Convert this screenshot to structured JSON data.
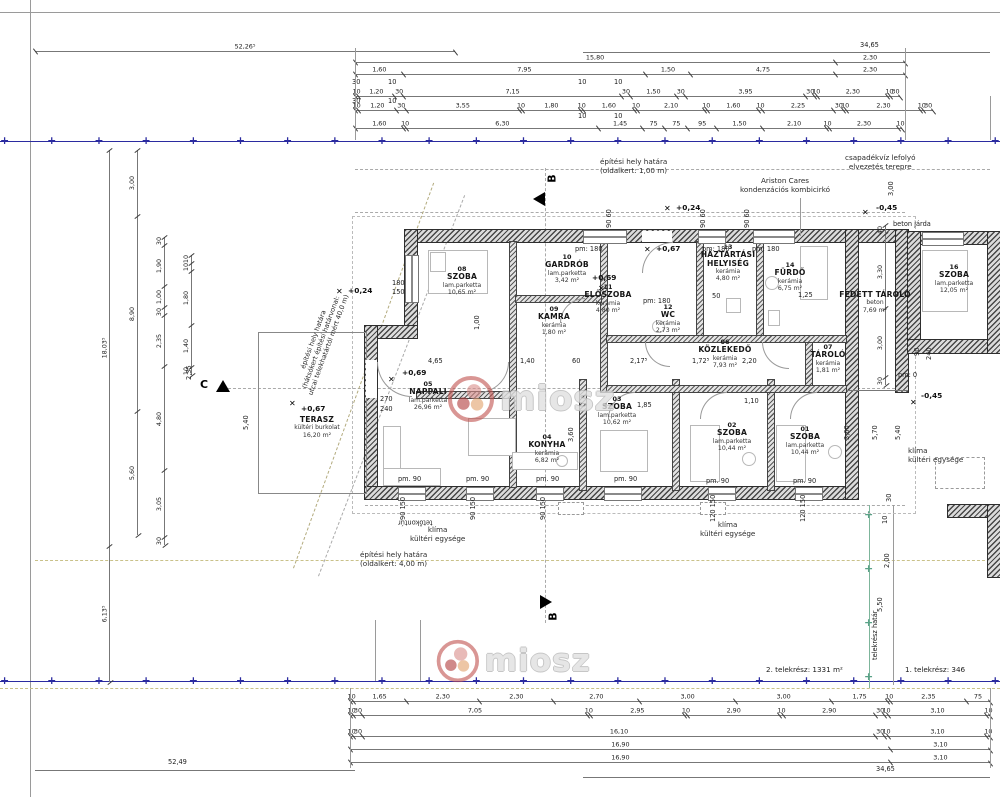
{
  "watermark": {
    "text": "miosz"
  },
  "rooms": {
    "r01": {
      "num": "01",
      "name": "SZOBA",
      "finish": "lam.parketta",
      "area": "10,44 m²"
    },
    "r02": {
      "num": "02",
      "name": "SZOBA",
      "finish": "lam.parketta",
      "area": "10,44 m²"
    },
    "r03": {
      "num": "03",
      "name": "SZOBA",
      "finish": "lam.parketta",
      "area": "10,62 m²"
    },
    "r04": {
      "num": "04",
      "name": "KONYHA",
      "finish": "kerámia",
      "area": "6,82 m²"
    },
    "r05": {
      "num": "05",
      "name": "NAPPALI",
      "finish": "lam.parketta",
      "area": "26,96 m²"
    },
    "r06": {
      "num": "06",
      "name": "KÖZLEKEDŐ",
      "finish": "kerámia",
      "area": "7,93 m²"
    },
    "r07": {
      "num": "07",
      "name": "TÁROLÓ",
      "finish": "kerámia",
      "area": "1,81 m²"
    },
    "r08": {
      "num": "08",
      "name": "SZOBA",
      "finish": "lam.parketta",
      "area": "10,65 m²"
    },
    "r09": {
      "num": "09",
      "name": "KAMRA",
      "finish": "kerámia",
      "area": "1,80 m²"
    },
    "r10": {
      "num": "10",
      "name": "GARDRÓB",
      "finish": "lam.parketta",
      "area": "3,42 m²"
    },
    "r11": {
      "num": "11",
      "name": "ELŐSZOBA",
      "finish": "kerámia",
      "area": "4,80 m²"
    },
    "r12": {
      "num": "12",
      "name": "WC",
      "finish": "kerámia",
      "area": "2,73 m²"
    },
    "r13": {
      "num": "13",
      "name": "HÁZTARTÁSI HELYISÉG",
      "finish": "kerámia",
      "area": "4,80 m²"
    },
    "r14": {
      "num": "14",
      "name": "FÜRDŐ",
      "finish": "kerámia",
      "area": "6,75 m²"
    },
    "r15": {
      "name": "FEDETT TÁROLÓ",
      "finish": "beton",
      "area": "7,69 m²"
    },
    "r16": {
      "num": "16",
      "name": "SZOBA",
      "finish": "lam.parketta",
      "area": "12,05 m²"
    },
    "terasz": {
      "name": "TERASZ",
      "finish": "kültéri burkolat",
      "area": "16,20 m²"
    }
  },
  "annotations": {
    "site_top1": "építési hely határa",
    "site_top2": "(oldalkert: 1,00 m)",
    "rain1": "csapadékvíz lefolyó",
    "rain2": "elvezetés terepre",
    "boiler1": "Ariston Cares",
    "boiler2": "kondenzációs kombicirkó",
    "walk": "beton járda",
    "rear1": "építési hely határa",
    "rear2": "(hátsókert építési határvonal:",
    "rear3": "utcai telekhatártól mért 40,0 m)",
    "site_bot1": "építési hely határa",
    "site_bot2": "(oldalkert: 4,00 m)",
    "roof": "tetőkontúr",
    "ac1": "klíma",
    "ac2": "kültéri egysége",
    "plotline": "telekrész határ",
    "plot2": "2. telekrész: 1331 m²",
    "plot1": "1. telekrész: 346"
  },
  "sections": {
    "b": "B",
    "c": "C"
  },
  "levels": {
    "l024": "+0,24",
    "l067": "+0,67",
    "l069": "+0,69",
    "l045": "-0,45"
  },
  "labels": {
    "d5226": "52,26⁵",
    "d3465": "34,65",
    "d5249": "52,49",
    "d465": "4,65",
    "d140": "1,40",
    "d60": "60",
    "d2175": "2,17⁵",
    "d1725": "1,72⁵",
    "d220": "2,20",
    "d185": "1,85",
    "d110": "1,10",
    "d125": "1,25",
    "d360": "3,60",
    "d50": "50",
    "d540": "5,40",
    "d235": "2,35",
    "d270": "270",
    "d240": "240",
    "d180": "180",
    "d150": "150",
    "d90": "90",
    "d120": "120",
    "d100": "1,00",
    "d570": "5,70",
    "d550": "5,50",
    "d300": "3,00",
    "d200": "2,00",
    "d30": "30",
    "d10": "10",
    "d90150": "90  150",
    "d120150": "120  150",
    "d9060": "90  60",
    "pm180": "pm: 180",
    "pm90": "pm. 90",
    "pm0": "pm: 0"
  },
  "dim_chains": {
    "top_a52": [
      "52,26⁵"
    ],
    "top_b": [
      "15,80",
      "2,30"
    ],
    "top_c": [
      "1,60",
      "7,95",
      "1,50",
      "4,75",
      "2,30"
    ],
    "top_e": [
      "10",
      "1,20",
      "30",
      "7,15",
      "30",
      "1,50",
      "30",
      "3,95",
      "30",
      "10",
      "2,30",
      "10",
      "30"
    ],
    "top_g": [
      "10",
      "1,20",
      "30",
      "3,55",
      "10",
      "1,80",
      "10",
      "1,60",
      "10",
      "2,10",
      "10",
      "1,60",
      "10",
      "2,25",
      "30",
      "10",
      "2,30",
      "10",
      "30"
    ],
    "top_i": [
      "1,60",
      "10",
      "6,30",
      "1,45",
      "75",
      "75",
      "95",
      "1,50",
      "2,10",
      "10",
      "2,30",
      "10"
    ],
    "bot_a": [
      "10",
      "1,65",
      "2,30",
      "2,30",
      "2,70",
      "3,00",
      "3,00",
      "1,75",
      "10",
      "2,35",
      "75"
    ],
    "bot_b": [
      "10",
      "30",
      "7,05",
      "10",
      "2,95",
      "10",
      "2,90",
      "10",
      "2,90",
      "30",
      "10",
      "3,10",
      "10"
    ],
    "bot_c": [
      "10",
      "30",
      "16,10",
      "30",
      "10",
      "3,10",
      "10"
    ],
    "bot_d": [
      "16,90",
      "3,10"
    ],
    "bot_e": [
      "16,90",
      "3,10"
    ],
    "left_a": [
      "18,03⁵",
      "6,13⁵"
    ],
    "left_b": [
      "3,00",
      "8,90",
      "5,60"
    ],
    "left_c": [
      "30",
      "1,90",
      "1,00",
      "30",
      "2,35",
      "4,80",
      "3,05",
      "30"
    ],
    "left_d": [
      "10",
      "10",
      "1,80",
      "1,40",
      "10"
    ],
    "right_a": [
      "40",
      "3,30",
      "3,00",
      "30"
    ]
  }
}
